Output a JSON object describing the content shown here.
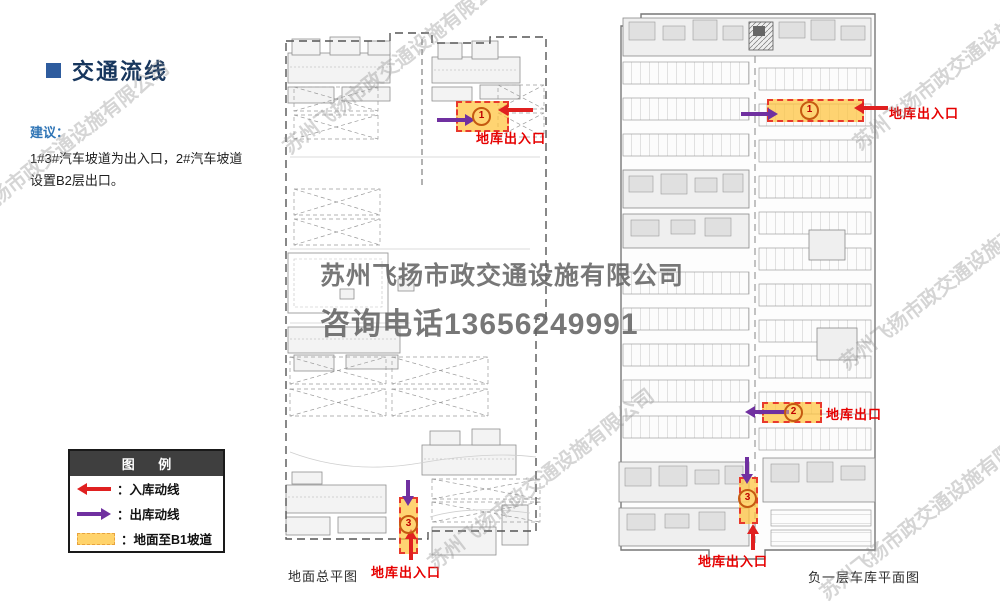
{
  "title": {
    "text": "交通流线"
  },
  "advice": {
    "heading": "建议：",
    "line1": "1#3#汽车坡道为出入口，2#汽车坡道",
    "line2": "设置B2层出口。"
  },
  "legend": {
    "title": "图  例",
    "items": [
      {
        "icon": "red-left-arrow-icon",
        "label": "：入库动线"
      },
      {
        "icon": "purple-right-arrow-icon",
        "label": "：出库动线"
      },
      {
        "icon": "orange-ramp-swatch-icon",
        "label": "：地面至B1坡道"
      }
    ]
  },
  "plans": {
    "ground": {
      "caption": "地面总平图",
      "zones": {
        "z1": {
          "num": "1",
          "label": "地库出入口"
        },
        "z3": {
          "num": "3",
          "label": "地库出入口"
        }
      }
    },
    "basement": {
      "caption": "负一层车库平面图",
      "zones": {
        "z1": {
          "num": "1",
          "label": "地库出入口"
        },
        "z2": {
          "num": "2",
          "label": "地库出口"
        },
        "z3": {
          "num": "3",
          "label": "地库出入口"
        }
      }
    }
  },
  "watermark": {
    "line1": "苏州飞扬市政交通设施有限公司",
    "line2": "咨询电话13656249991",
    "diagonal": "苏州飞扬市政交通设施有限公司"
  },
  "colors": {
    "title_blue": "#17365D",
    "bullet_blue": "#2E5C9E",
    "advice_blue": "#2E74B5",
    "inbound_red": "#E02020",
    "outbound_purple": "#7030A0",
    "ramp_fill": "#FFC43C",
    "ramp_border": "#E8392C",
    "zone_label_red": "#E60000",
    "legend_header_bg": "#3F3F3F"
  }
}
